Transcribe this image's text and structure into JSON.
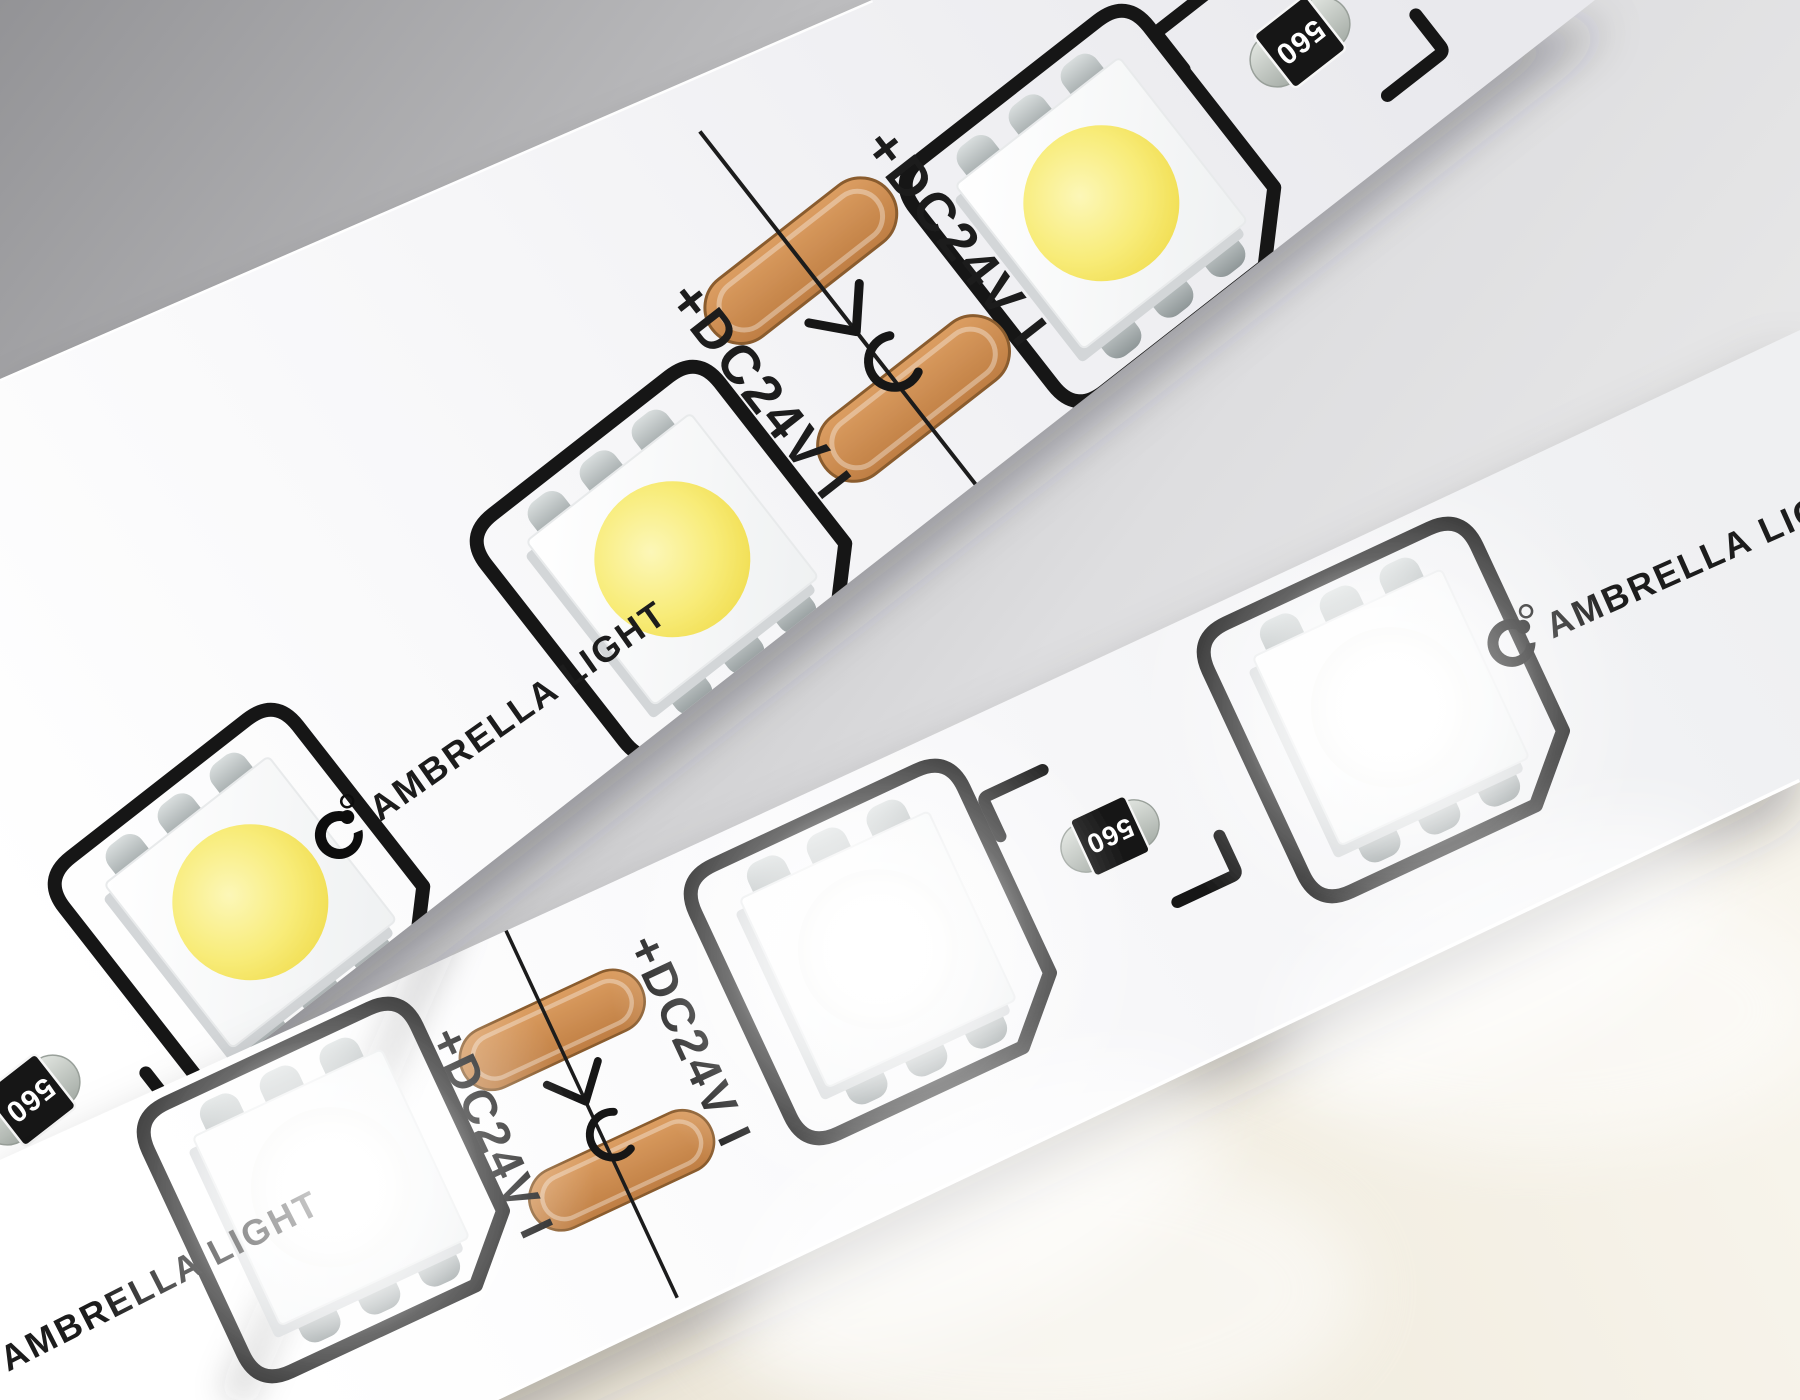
{
  "brand": {
    "name": "AMBRELLA LIGHT",
    "registered_mark": "®"
  },
  "markings": {
    "voltage_label": "+DC24V I",
    "resistor_value": "560"
  },
  "strips": {
    "warm": {
      "role": "warm-white-led-strip",
      "visible_leds": 3,
      "led_die_color": "#F5E76B",
      "state": "unlit"
    },
    "cool": {
      "role": "cool-white-led-strip",
      "visible_leds": 3,
      "led_die_color": "#FFFFFF",
      "state": "glowing"
    }
  },
  "colors": {
    "background_top_left": "#96969A",
    "background_mid": "#D9D9DB",
    "pcb_face": "#FAFAFB",
    "silkscreen": "#1B1B1B",
    "solder_pad": "#CE9257",
    "resistor_body": "#141414",
    "resistor_cap": "#C2C7C1",
    "warm_glow_floor": "#F1ECDF"
  }
}
